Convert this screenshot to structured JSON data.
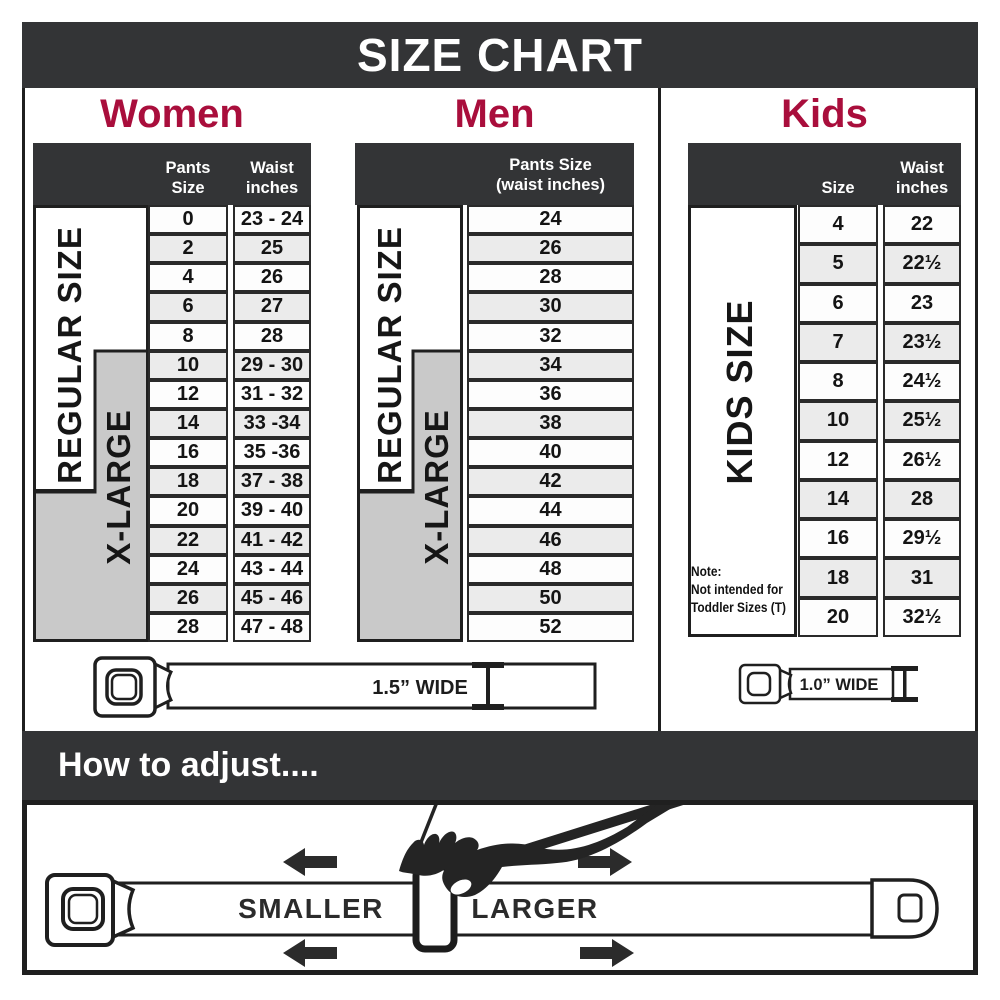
{
  "title": "SIZE CHART",
  "colors": {
    "accent_red": "#A90E3C",
    "header_dark": "#333436",
    "xlarge_gray": "#C9C9C9",
    "row_alt_gray": "#EBEBEB"
  },
  "women": {
    "title": "Women",
    "header": {
      "col1": "Pants Size",
      "col2_line1": "Waist",
      "col2_line2": "inches"
    },
    "regular_label": "REGULAR SIZE",
    "xlarge_label": "X-LARGE",
    "rows": [
      {
        "size": "0",
        "waist": "23 - 24"
      },
      {
        "size": "2",
        "waist": "25"
      },
      {
        "size": "4",
        "waist": "26"
      },
      {
        "size": "6",
        "waist": "27"
      },
      {
        "size": "8",
        "waist": "28"
      },
      {
        "size": "10",
        "waist": "29 - 30"
      },
      {
        "size": "12",
        "waist": "31 - 32"
      },
      {
        "size": "14",
        "waist": "33 -34"
      },
      {
        "size": "16",
        "waist": "35 -36"
      },
      {
        "size": "18",
        "waist": "37 - 38"
      },
      {
        "size": "20",
        "waist": "39 - 40"
      },
      {
        "size": "22",
        "waist": "41 - 42"
      },
      {
        "size": "24",
        "waist": "43 - 44"
      },
      {
        "size": "26",
        "waist": "45 - 46"
      },
      {
        "size": "28",
        "waist": "47 - 48"
      }
    ],
    "belt_label": "1.5” WIDE"
  },
  "men": {
    "title": "Men",
    "header": {
      "col1_line1": "Pants Size",
      "col1_line2": "(waist inches)"
    },
    "regular_label": "REGULAR SIZE",
    "xlarge_label": "X-LARGE",
    "rows": [
      "24",
      "26",
      "28",
      "30",
      "32",
      "34",
      "36",
      "38",
      "40",
      "42",
      "44",
      "46",
      "48",
      "50",
      "52"
    ]
  },
  "kids": {
    "title": "Kids",
    "header": {
      "col1": "Size",
      "col2_line1": "Waist",
      "col2_line2": "inches"
    },
    "side_label": "KIDS SIZE",
    "note": {
      "line1": "Note:",
      "line2": "Not intended for",
      "line3": "Toddler Sizes (T)"
    },
    "rows": [
      {
        "size": "4",
        "waist": "22"
      },
      {
        "size": "5",
        "waist": "22½"
      },
      {
        "size": "6",
        "waist": "23"
      },
      {
        "size": "7",
        "waist": "23½"
      },
      {
        "size": "8",
        "waist": "24½"
      },
      {
        "size": "10",
        "waist": "25½"
      },
      {
        "size": "12",
        "waist": "26½"
      },
      {
        "size": "14",
        "waist": "28"
      },
      {
        "size": "16",
        "waist": "29½"
      },
      {
        "size": "18",
        "waist": "31"
      },
      {
        "size": "20",
        "waist": "32½"
      }
    ],
    "belt_label": "1.0” WIDE"
  },
  "adjust_section": {
    "heading": "How to adjust....",
    "smaller_label": "SMALLER",
    "larger_label": "LARGER"
  }
}
